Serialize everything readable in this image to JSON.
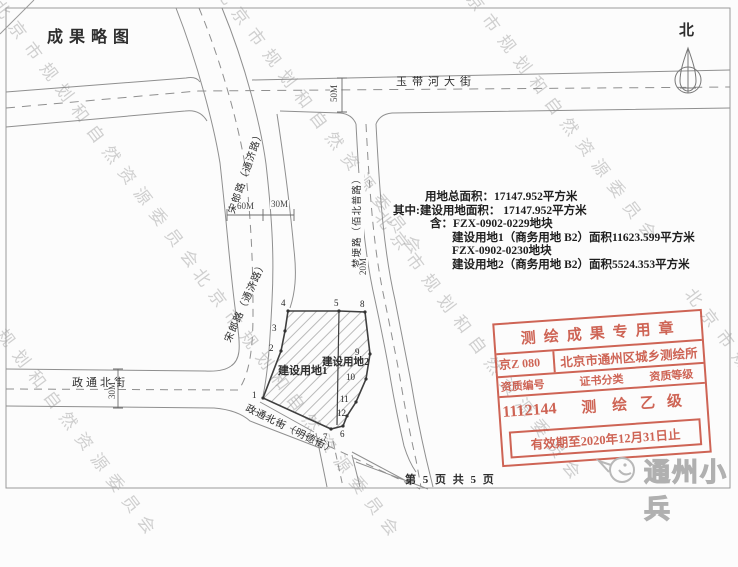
{
  "page": {
    "title": "成果略图",
    "footer": "第 5 页  共 5 页"
  },
  "north": {
    "label": "北"
  },
  "watermark": {
    "text": "北京市规划和自然资源委员会"
  },
  "roads": {
    "yudaihe": "玉带河大街",
    "songlang": "宋郎路（通济路）",
    "mengpu": "梦埂路（佰北普路）",
    "zhengtong": "政通北街",
    "mingde": "政通北街（明德街）"
  },
  "dimensions": {
    "street_width": "50M",
    "songlang_width": "60M",
    "belt_width": "30M",
    "mengpu_width": "20M",
    "zhengtong_width": "30M"
  },
  "info": {
    "lines": [
      "用地总面积：17147.952平方米",
      "其中:建设用地面积： 17147.952平方米",
      "含：FZX-0902-0229地块",
      "建设用地1（商务用地 B2）面积11623.599平方米",
      "FZX-0902-0230地块",
      "建设用地2（商务用地 B2）面积5524.353平方米"
    ]
  },
  "plot": {
    "parcel1_label": "建设用地1",
    "parcel2_label": "建设用地2",
    "vertices": [
      "1",
      "2",
      "3",
      "4",
      "5",
      "6",
      "7",
      "8",
      "9",
      "10",
      "11",
      "12"
    ]
  },
  "stamp": {
    "title": "测绘成果专用章",
    "cert_prefix": "京Z 080",
    "org_name": "北京市通州区城乡测绘所",
    "col_headers": [
      "资质编号",
      "证书分类",
      "资质等级"
    ],
    "cert_number": "1112144",
    "category": "测 绘",
    "grade": "乙 级",
    "validity": "有效期至2020年12月31日止",
    "color": "#c8503f"
  },
  "logo": {
    "text": "通州小兵"
  }
}
